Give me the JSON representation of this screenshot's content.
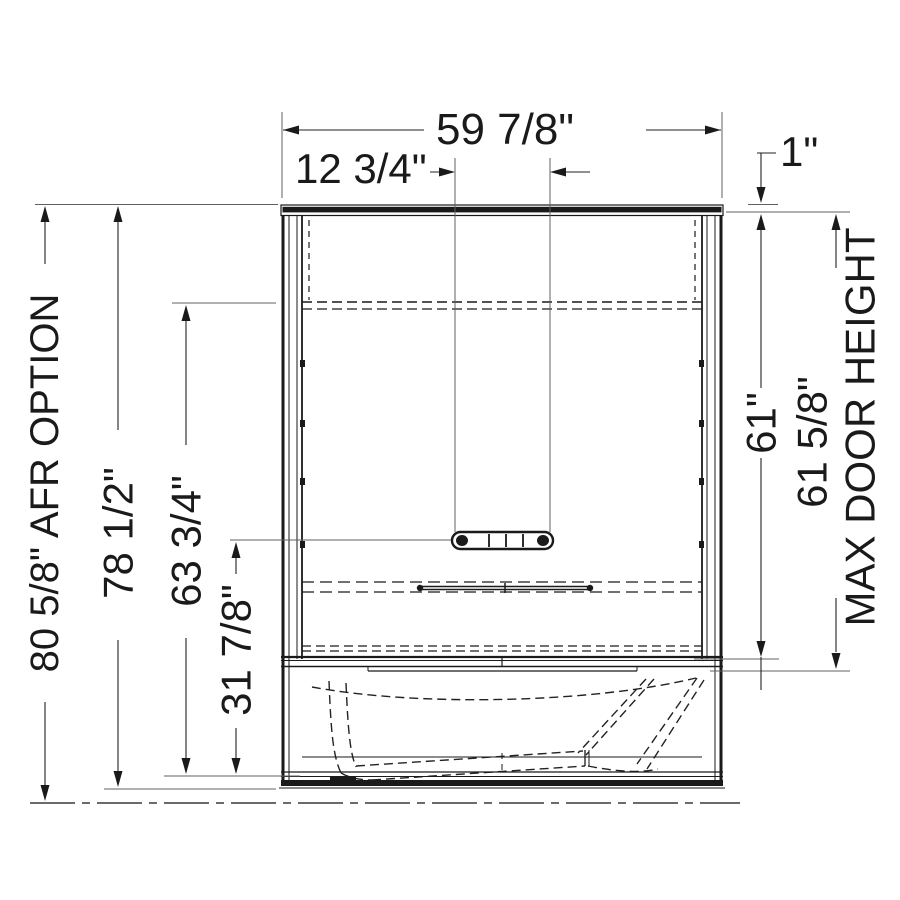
{
  "drawing": {
    "title": "tub-shower unit front elevation dimension drawing",
    "labels": {
      "overall_width": "59 7/8\"",
      "grab_bar_width": "12 3/4\"",
      "top_clearance": "1\"",
      "afr_option_height": "80 5/8\" AFR OPTION",
      "overall_height": "78 1/2\"",
      "wall_top_height": "63 3/4\"",
      "grab_bar_height": "31 7/8\"",
      "door_opening_height": "61\"",
      "max_door_height_value": "61 5/8\"",
      "max_door_height_note": "MAX DOOR HEIGHT"
    },
    "colors": {
      "object_line": "#1a1a1a",
      "dimension_line": "#222222",
      "extension_line": "#606060",
      "background": "#ffffff"
    }
  }
}
